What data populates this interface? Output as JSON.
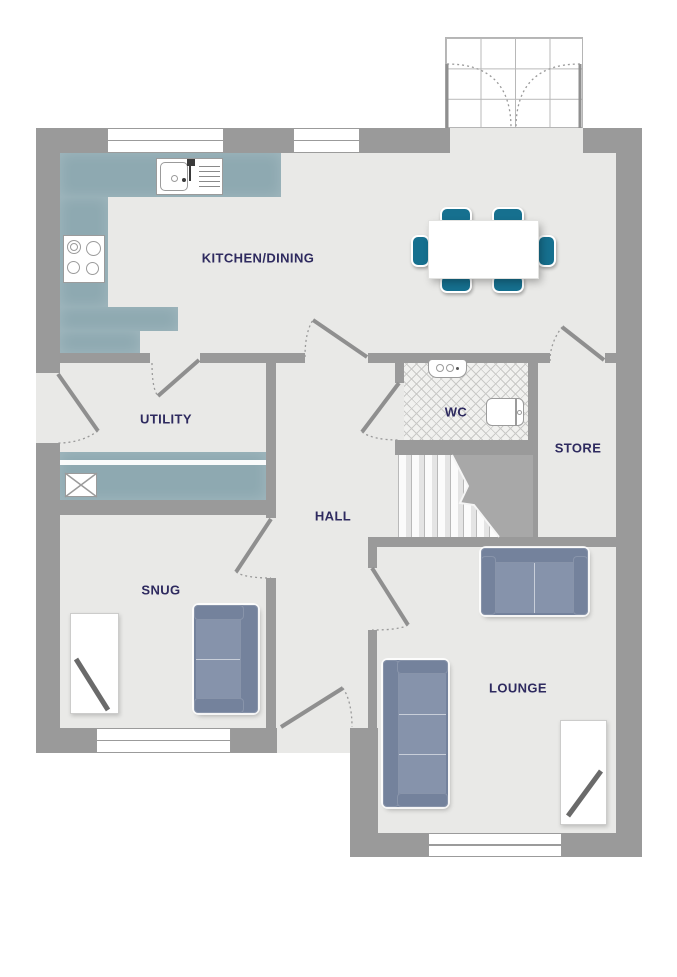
{
  "rooms": {
    "kitchen_dining": {
      "label": "KITCHEN/DINING"
    },
    "utility": {
      "label": "UTILITY"
    },
    "wc": {
      "label": "WC"
    },
    "store": {
      "label": "STORE"
    },
    "hall": {
      "label": "HALL"
    },
    "snug": {
      "label": "SNUG"
    },
    "lounge": {
      "label": "LOUNGE"
    }
  },
  "colors": {
    "wall": "#9a9a9a",
    "floor": "#e9e9e7",
    "counter": "#8ea9b1",
    "wc_floor": "#f1f1ef",
    "hatch": "#c9c9c7",
    "sofa": "#74829c",
    "sofa_seat": "#8693ab",
    "chair": "#16708f",
    "label_text": "#2e2a5f",
    "fixture_border": "#9b9b9b",
    "stairs_cut": "#a8a8a8"
  },
  "icons": {
    "kitchen-sink-icon": "rect-with-bowl-and-drainer",
    "hob-icon": "four-burner-rings",
    "washing-machine-icon": "square-with-cross",
    "basin-icon": "rounded-rect-with-taps",
    "toilet-icon": "rounded-rect-with-cistern",
    "stairs-icon": "treads-with-break-line",
    "dining-table-icon": "white-rectangle",
    "dining-chair-icon": "teal-rounded-rect",
    "sofa-icon": "blue-sofa-plan-symbol",
    "tv-unit-icon": "white-rect-with-diagonal",
    "door-icon": "leaf-with-dashed-swing-arc",
    "window-icon": "double-pane-strip",
    "porch-icon": "glazed-grid-with-double-doors"
  }
}
